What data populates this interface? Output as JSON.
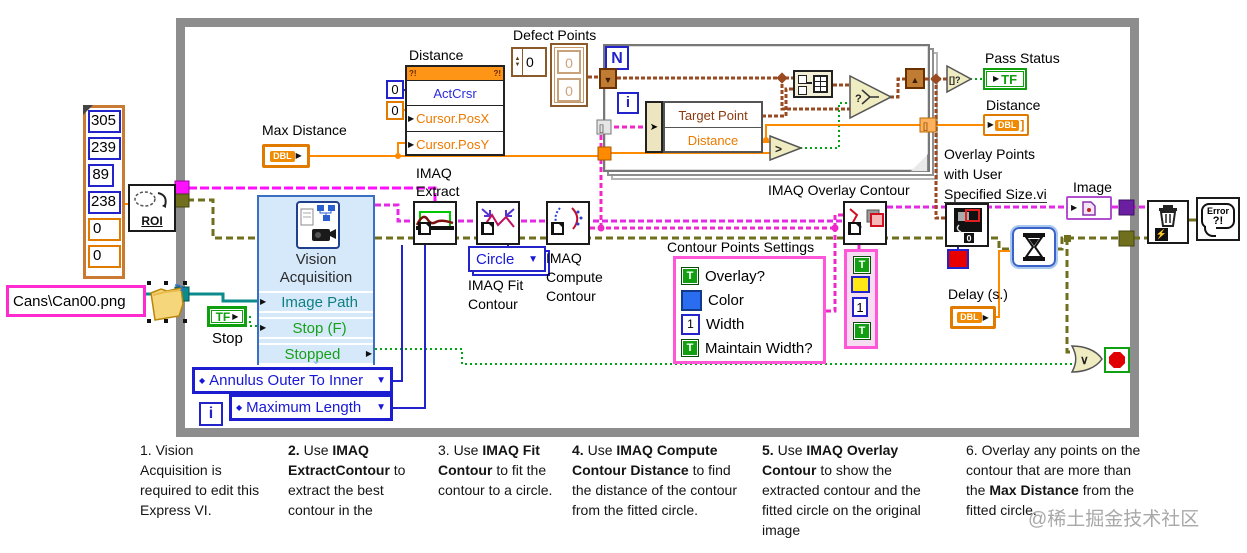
{
  "icons": {
    "arrow": "▶",
    "dropdown": "▼",
    "diamond": "◆",
    "shift_down": "▼",
    "shift_up": "▲",
    "bolt": "⚡",
    "or": "∨",
    "gt": ">",
    "select_q": "?",
    "empty_array": "[]?",
    "t": "T",
    "n": "N",
    "i": "i",
    "tf": "TF",
    "dbl": "DBL",
    "qmark_bang": "?!",
    "chevron": "⌄",
    "bracket_close": "]",
    "zero": "0"
  },
  "roi_cluster": {
    "values": [
      "305",
      "239",
      "89",
      "238",
      "0",
      "0"
    ]
  },
  "roi_node": {
    "label": "ROI"
  },
  "path_constant": {
    "value": "Cans\\Can00.png"
  },
  "max_distance": {
    "label": "Max Distance"
  },
  "property_node": {
    "label": "Distance",
    "rows": [
      "ActCrsr",
      "Cursor.PosX",
      "Cursor.PosY"
    ],
    "constants": [
      "0",
      "0"
    ]
  },
  "defect_points": {
    "label": "Defect Points",
    "index": "0",
    "elements": [
      "0",
      "0"
    ]
  },
  "for_loop": {
    "unbundle_rows": [
      "Target Point",
      "Distance"
    ]
  },
  "pass_status": {
    "label": "Pass Status"
  },
  "distance_out": {
    "label": "Distance"
  },
  "overlay_points": {
    "label_lines": [
      "Overlay Points",
      "with User",
      "Specified Size.vi"
    ]
  },
  "image_out": {
    "label": "Image"
  },
  "delay": {
    "label": "Delay (s.)"
  },
  "vision_acquisition": {
    "title_lines": [
      "Vision",
      "Acquisition"
    ],
    "rows": [
      "Image Path",
      "Stop (F)",
      "Stopped"
    ]
  },
  "stop_control": {
    "label": "Stop"
  },
  "enums": {
    "contour_mode": "Annulus Outer To Inner",
    "length_mode": "Maximum Length",
    "fit_shape": "Circle"
  },
  "imaq_nodes": {
    "extract_label_lines": [
      "IMAQ",
      "Extract"
    ],
    "fit_label_lines": [
      "IMAQ Fit",
      "Contour"
    ],
    "compute_label_lines": [
      "IMAQ",
      "Compute",
      "Contour"
    ],
    "overlay_label": "IMAQ Overlay Contour"
  },
  "contour_settings": {
    "title": "Contour Points Settings",
    "rows": [
      {
        "label": "Overlay?"
      },
      {
        "label": "Color"
      },
      {
        "label": "Width",
        "value": "1"
      },
      {
        "label": "Maintain Width?"
      }
    ]
  },
  "overlay_const": {
    "width_value": "1"
  },
  "error_handler": {
    "line1": "Error",
    "line2": "?!"
  },
  "instructions": [
    {
      "segments": [
        {
          "t": "1. Vision Acquisition is required to edit this Express VI.",
          "b": false
        }
      ]
    },
    {
      "segments": [
        {
          "t": "2.",
          "b": true
        },
        {
          "t": " Use ",
          "b": false
        },
        {
          "t": "IMAQ ExtractContour",
          "b": true
        },
        {
          "t": " to extract the best contour in the",
          "b": false
        }
      ]
    },
    {
      "segments": [
        {
          "t": "3. Use ",
          "b": false
        },
        {
          "t": "IMAQ Fit Contour",
          "b": true
        },
        {
          "t": " to fit the contour to a circle.",
          "b": false
        }
      ]
    },
    {
      "segments": [
        {
          "t": "4.",
          "b": true
        },
        {
          "t": " Use ",
          "b": false
        },
        {
          "t": "IMAQ Compute Contour Distance",
          "b": true
        },
        {
          "t": " to find the distance of the contour from the fitted circle.",
          "b": false
        }
      ]
    },
    {
      "segments": [
        {
          "t": "5.",
          "b": true
        },
        {
          "t": " Use ",
          "b": false
        },
        {
          "t": "IMAQ Overlay Contour",
          "b": true
        },
        {
          "t": " to show the extracted contour and the fitted circle on the original image",
          "b": false
        }
      ]
    },
    {
      "segments": [
        {
          "t": "6. Overlay any points on the contour that are more than the ",
          "b": false
        },
        {
          "t": "Max Distance",
          "b": true
        },
        {
          "t": " from the fitted circle.",
          "b": false
        }
      ]
    }
  ],
  "watermark": "@稀土掘金技术社区"
}
